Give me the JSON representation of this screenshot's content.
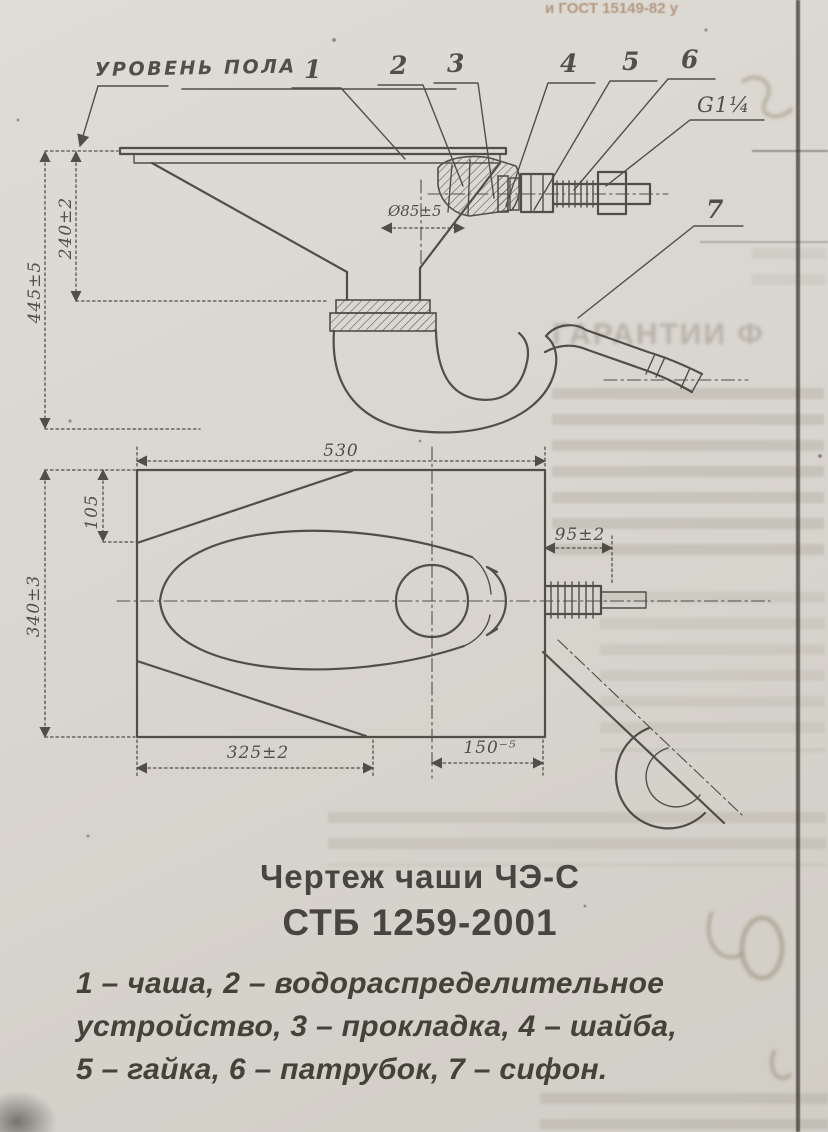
{
  "page": {
    "background": "#d8d5ce",
    "ink": "#3f3b35"
  },
  "side_view": {
    "floor_label": "УРОВЕНЬ ПОЛА",
    "thread_label": "G1¼",
    "callouts": [
      "1",
      "2",
      "3",
      "4",
      "5",
      "6",
      "7"
    ],
    "dim_overall_height": "445±5",
    "dim_bowl_height": "240±2",
    "dim_outlet_diameter": "Ø85±5"
  },
  "plan_view": {
    "dim_length": "530",
    "dim_front_edge": "105",
    "dim_width": "340±3",
    "dim_left_to_outlet": "325±2",
    "dim_outlet_to_edge": "150⁻⁵",
    "dim_spigot_offset": "95±2"
  },
  "caption": {
    "line1": "Чертеж чаши ЧЭ-С",
    "line2": "СТБ 1259-2001"
  },
  "legend": {
    "line1": "1 –  чаша, 2 –  водораспределительное",
    "line2": "устройство, 3 –  прокладка, 4 –  шайба,",
    "line3": "5 –  гайка, 6 –  патрубок, 7 –  сифон."
  },
  "bleedthrough": {
    "top_line": "и ГОСТ 15149-82 у",
    "heading_fragment": "ГАРАНТИИ Ф"
  }
}
